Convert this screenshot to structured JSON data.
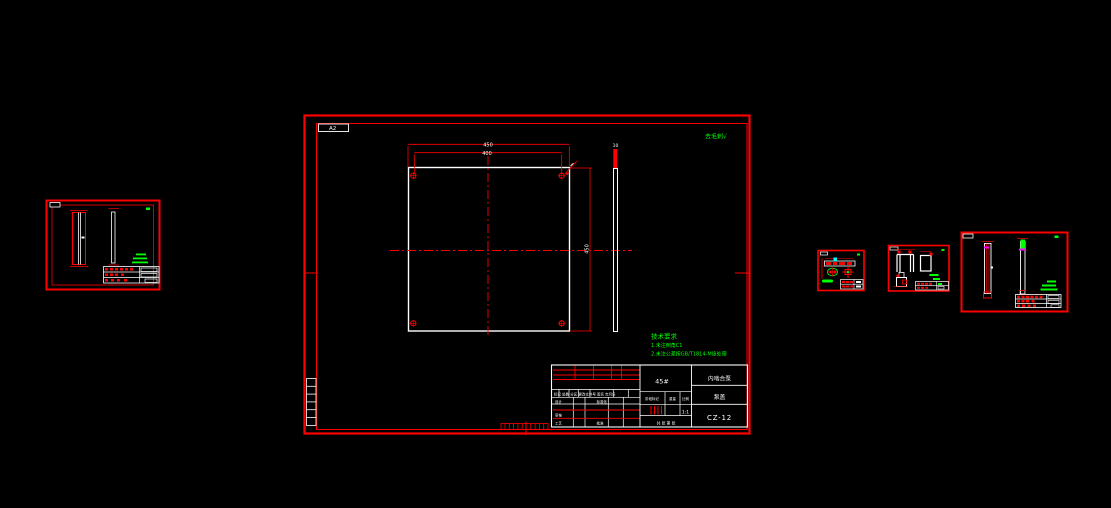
{
  "canvas": {
    "width": 1111,
    "height": 508,
    "background": "#000000"
  },
  "colors": {
    "line_red": "#ff0000",
    "line_white": "#ffffff",
    "note_green": "#00ff00",
    "accent_cyan": "#00ffff",
    "accent_magenta": "#ff00ff"
  },
  "main_sheet": {
    "format_label": "A2",
    "finish_note": "去毛刺√",
    "tech_requirements": {
      "title": "技术要求",
      "line1": "1.未注倒角C1",
      "line2": "2.未注公差按GB/T1814-M级处理"
    },
    "dimensions": {
      "overall_width": "450",
      "hole_spacing": "400",
      "overall_height": "450",
      "thickness": "10"
    },
    "title_block": {
      "org": "内啮合泵",
      "part_name": "泵盖",
      "drawing_no": "CZ-12",
      "material": "45#",
      "revision_header": "标记 处数 分区 更改文件号 签名 年月日",
      "row_design": "设计",
      "row_standard": "标准化",
      "row_check": "审核",
      "row_process": "工艺",
      "row_approve": "批准",
      "stage_label": "阶段标记",
      "weight_label": "重量",
      "scale_label": "比例",
      "scale_value": "1:1",
      "sheet_label": "共 张 第 张"
    }
  }
}
